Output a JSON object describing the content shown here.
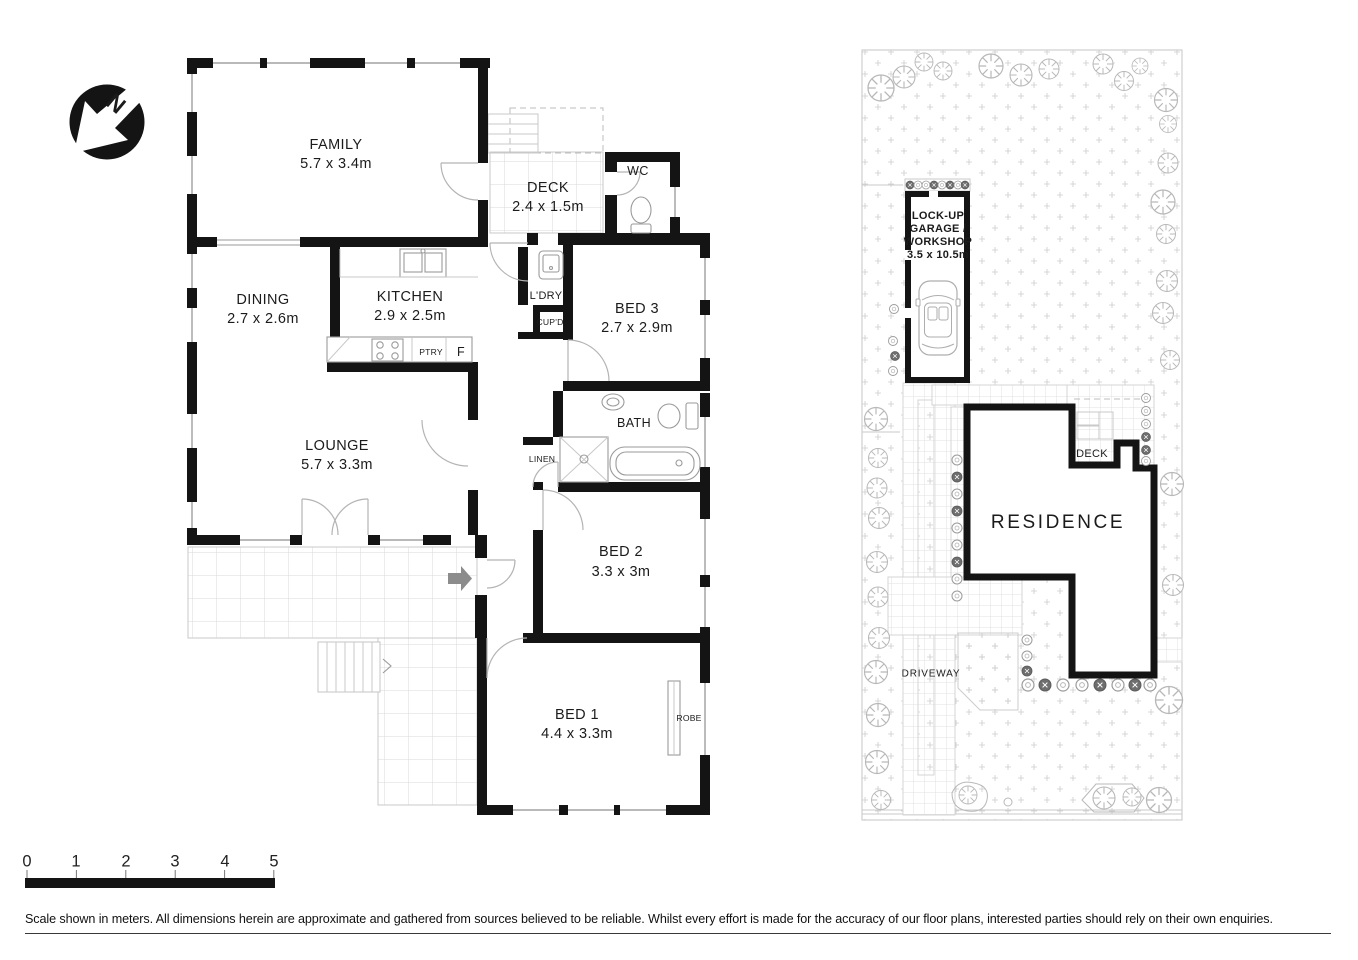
{
  "north": {
    "label": "N"
  },
  "colors": {
    "walls": "#141414",
    "paper": "#ffffff",
    "entry_arrow": "#8c8c8c"
  },
  "floorplan": {
    "rooms": {
      "family": {
        "name": "FAMILY",
        "dims": "5.7 x 3.4m"
      },
      "deck": {
        "name": "DECK",
        "dims": "2.4 x 1.5m"
      },
      "wc": {
        "name": "WC"
      },
      "dining": {
        "name": "DINING",
        "dims": "2.7 x 2.6m"
      },
      "kitchen": {
        "name": "KITCHEN",
        "dims": "2.9 x 2.5m"
      },
      "laundry": {
        "name": "L'DRY"
      },
      "cupboard": {
        "name": "CUP'D"
      },
      "pantry": {
        "name": "PTRY"
      },
      "fridge": {
        "name": "F"
      },
      "bed3": {
        "name": "BED 3",
        "dims": "2.7 x 2.9m"
      },
      "lounge": {
        "name": "LOUNGE",
        "dims": "5.7 x 3.3m"
      },
      "bath": {
        "name": "BATH"
      },
      "linen": {
        "name": "LINEN"
      },
      "bed2": {
        "name": "BED 2",
        "dims": "3.3 x 3m"
      },
      "bed1": {
        "name": "BED 1",
        "dims": "4.4 x 3.3m"
      },
      "robe": {
        "name": "ROBE"
      }
    }
  },
  "siteplan": {
    "garage": {
      "line1": "LOCK-UP",
      "line2": "GARAGE /",
      "line3": "WORKSHOP",
      "dims": "3.5 x 10.5m"
    },
    "residence": "RESIDENCE",
    "deck": "DECK",
    "driveway": "DRIVEWAY"
  },
  "scalebar": {
    "ticks": [
      "0",
      "1",
      "2",
      "3",
      "4",
      "5"
    ]
  },
  "footer": {
    "disclaimer": "Scale shown in meters. All dimensions herein are approximate and gathered from sources believed to be  reliable. Whilst every effort is made for the accuracy of our floor plans, interested parties should rely on their own enquiries."
  }
}
